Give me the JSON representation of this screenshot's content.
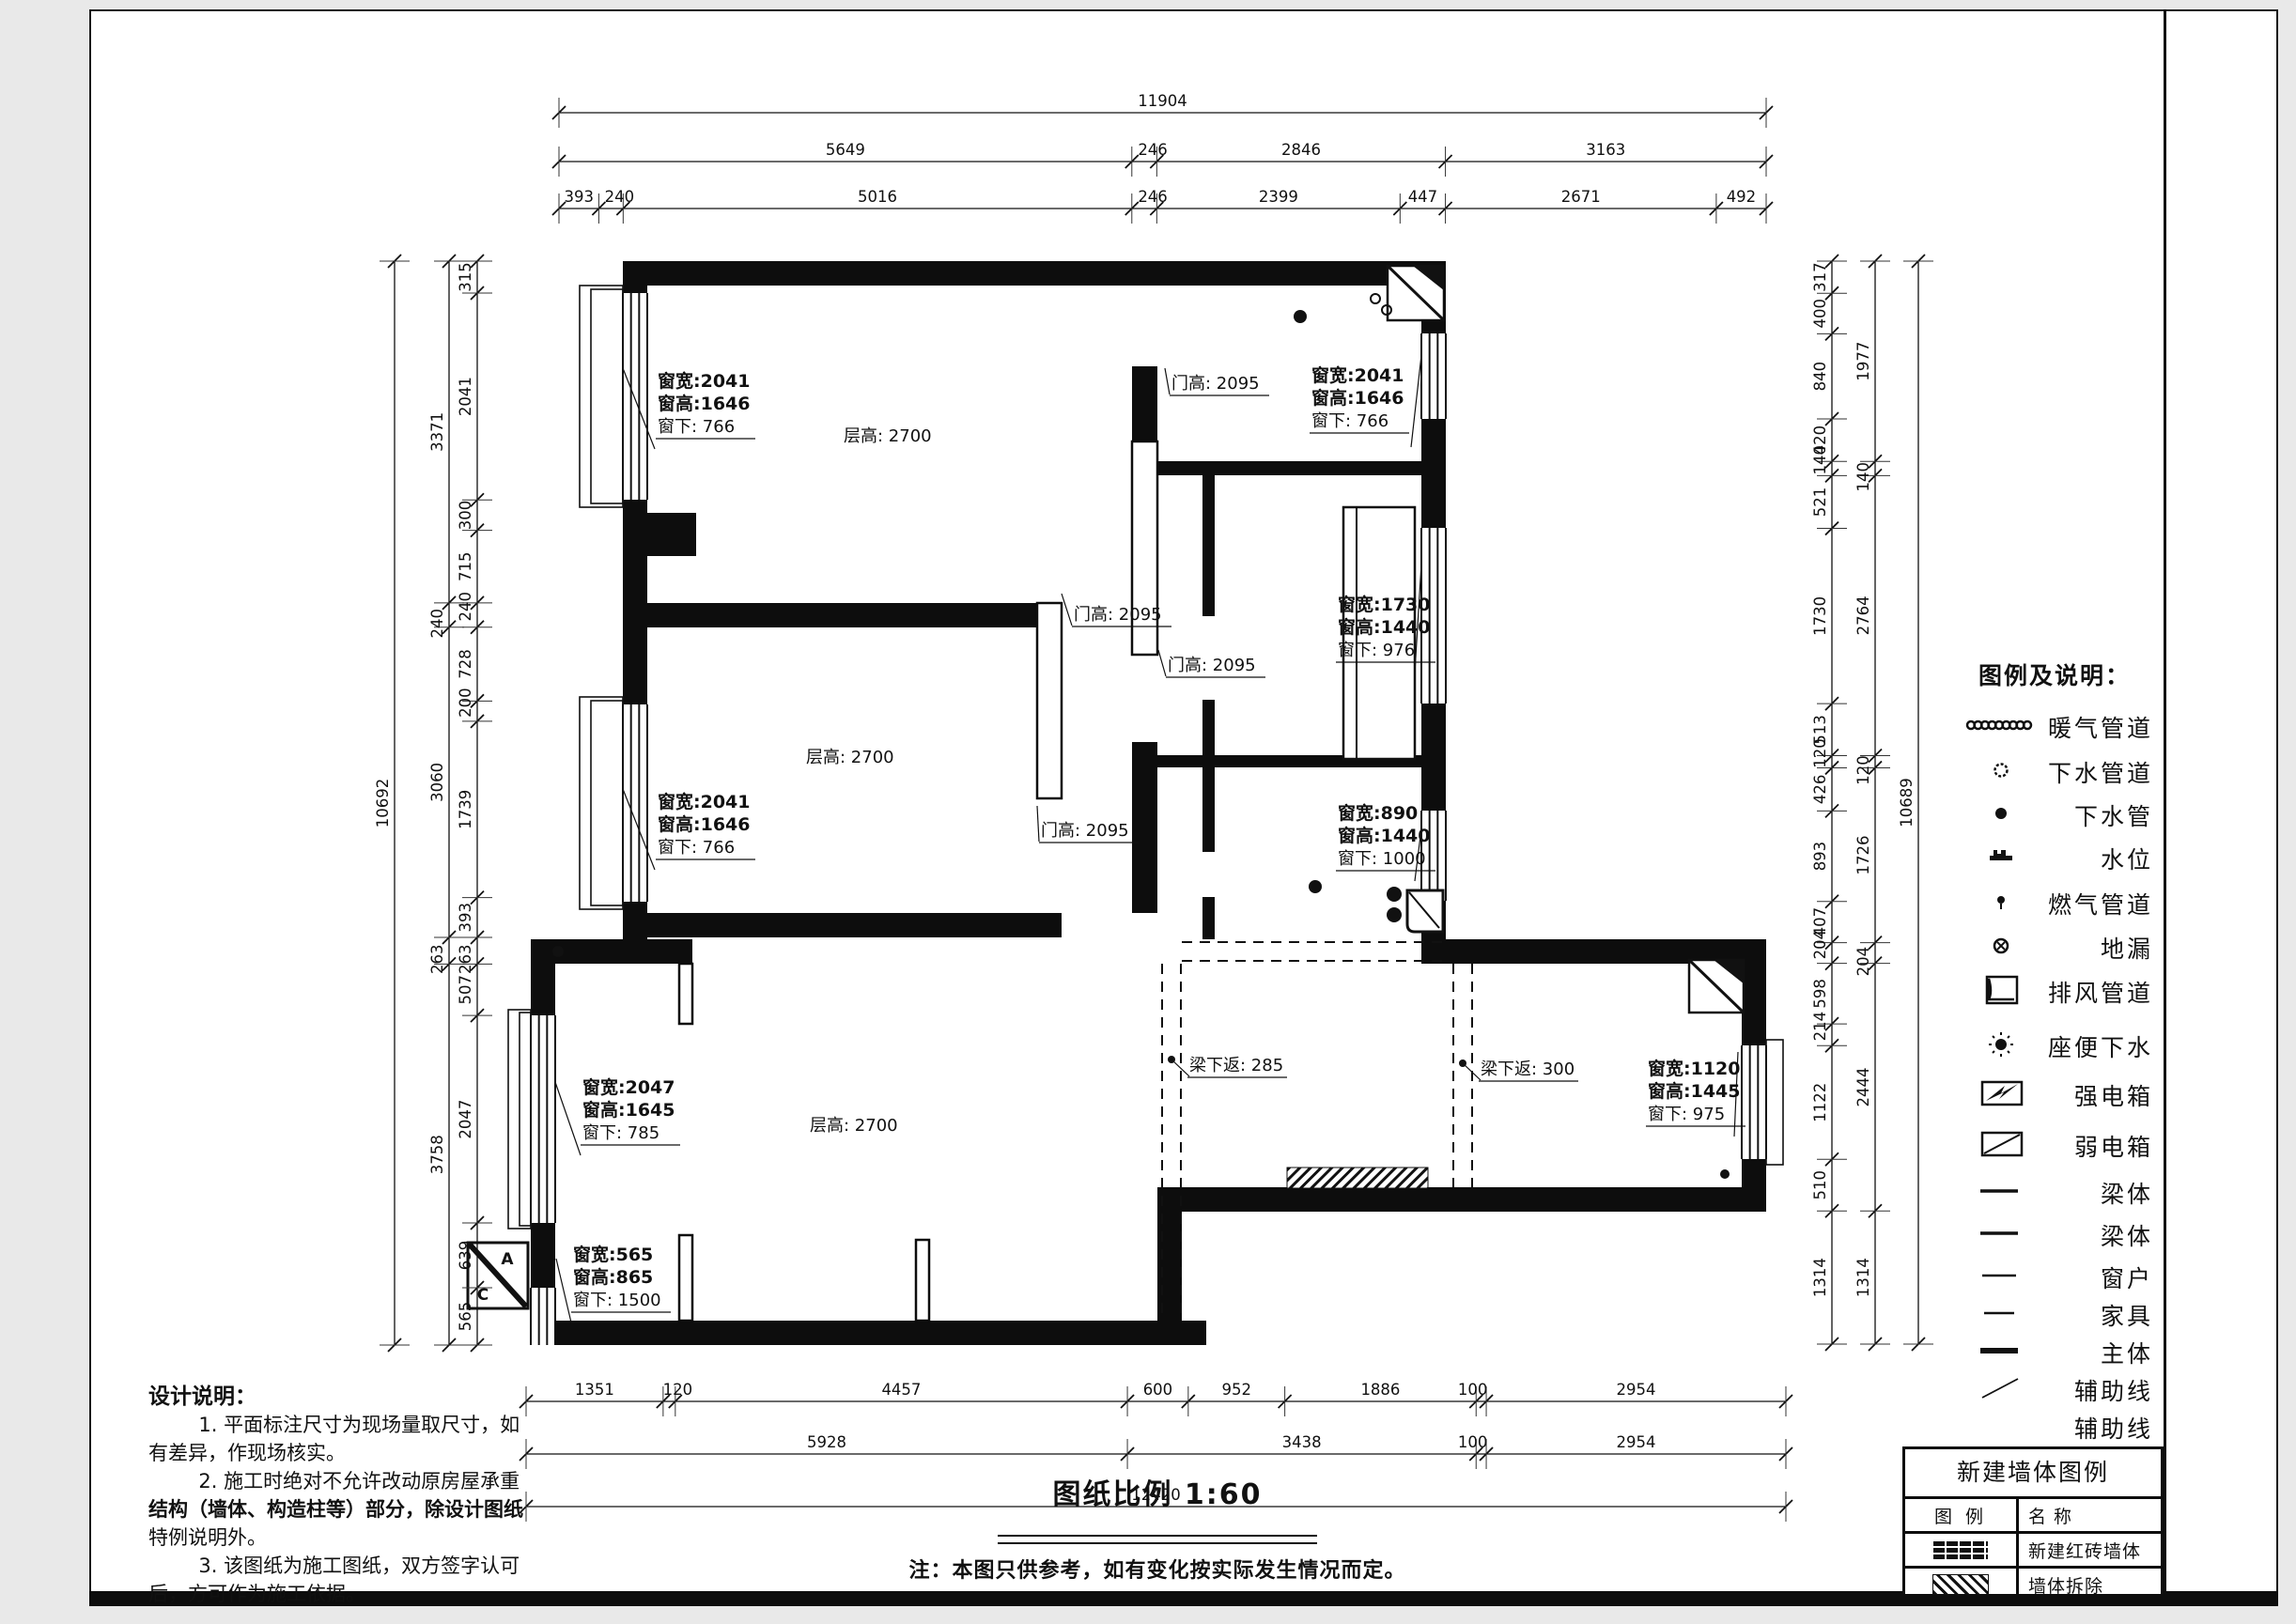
{
  "sheet": {
    "scale_note": "图纸比例 1:60",
    "disclaimer": "注：本图只供参考，如有变化按实际发生情况而定。"
  },
  "dimensions": {
    "top": [
      [
        11904
      ],
      [
        5649,
        246,
        2846,
        3163
      ],
      [
        393,
        240,
        5016,
        246,
        2399,
        447,
        2671,
        492
      ]
    ],
    "left": [
      [
        10692
      ],
      [
        3371,
        240,
        3060,
        263,
        3758
      ],
      [
        315,
        2041,
        300,
        715,
        240,
        728,
        200,
        1739,
        393,
        263,
        507,
        2047,
        639,
        565
      ]
    ],
    "right": [
      [
        317,
        400,
        840,
        420,
        140,
        521,
        1730,
        513,
        120,
        426,
        893,
        407,
        204,
        598,
        214,
        1122,
        510,
        1314
      ],
      [
        1977,
        140,
        2764,
        120,
        1726,
        204,
        2444,
        1314
      ],
      [
        10689
      ]
    ],
    "bottom": [
      [
        1351,
        120,
        4457,
        600,
        952,
        1886,
        100,
        2954
      ],
      [
        5928,
        3438,
        100,
        2954
      ],
      [
        12420
      ]
    ]
  },
  "callouts": [
    {
      "id": "c1",
      "type": "window",
      "lines": [
        "窗宽:2041",
        "窗高:1646",
        "窗下: 766"
      ]
    },
    {
      "id": "c2",
      "type": "height",
      "lines": [
        "层高: 2700"
      ]
    },
    {
      "id": "c3",
      "type": "door",
      "lines": [
        "门高: 2095"
      ]
    },
    {
      "id": "c4",
      "type": "window",
      "lines": [
        "窗宽:2041",
        "窗高:1646",
        "窗下: 766"
      ]
    },
    {
      "id": "c5",
      "type": "window",
      "lines": [
        "窗宽:1730",
        "窗高:1440",
        "窗下: 976"
      ]
    },
    {
      "id": "c6",
      "type": "door",
      "lines": [
        "门高: 2095"
      ]
    },
    {
      "id": "c7",
      "type": "door",
      "lines": [
        "门高: 2095"
      ]
    },
    {
      "id": "c8",
      "type": "height",
      "lines": [
        "层高: 2700"
      ]
    },
    {
      "id": "c9",
      "type": "window",
      "lines": [
        "窗宽:2041",
        "窗高:1646",
        "窗下: 766"
      ]
    },
    {
      "id": "c10",
      "type": "door",
      "lines": [
        "门高: 2095"
      ]
    },
    {
      "id": "c11",
      "type": "window",
      "lines": [
        "窗宽:890",
        "窗高:1440",
        "窗下: 1000"
      ]
    },
    {
      "id": "c12",
      "type": "window",
      "lines": [
        "窗宽:2047",
        "窗高:1645",
        "窗下: 785"
      ]
    },
    {
      "id": "c13",
      "type": "height",
      "lines": [
        "层高: 2700"
      ]
    },
    {
      "id": "c14",
      "type": "beam",
      "lines": [
        "梁下返: 285"
      ]
    },
    {
      "id": "c15",
      "type": "beam",
      "lines": [
        "梁下返: 300"
      ]
    },
    {
      "id": "c16",
      "type": "window",
      "lines": [
        "窗宽:1120",
        "窗高:1445",
        "窗下: 975"
      ]
    },
    {
      "id": "c17",
      "type": "window",
      "lines": [
        "窗宽:565",
        "窗高:865",
        "窗下: 1500"
      ]
    }
  ],
  "legend": {
    "title": "图例及说明：",
    "items": [
      {
        "symbol": "radiator",
        "label": "暖气管道"
      },
      {
        "symbol": "drain-open",
        "label": "下水管道"
      },
      {
        "symbol": "drain-dot",
        "label": "下水管"
      },
      {
        "symbol": "water-level",
        "label": "水位"
      },
      {
        "symbol": "gas",
        "label": "燃气管道"
      },
      {
        "symbol": "floor-drain",
        "label": "地漏"
      },
      {
        "symbol": "vent",
        "label": "排风管道"
      },
      {
        "symbol": "toilet-drain",
        "label": "座便下水"
      },
      {
        "symbol": "strong-box",
        "label": "强电箱"
      },
      {
        "symbol": "weak-box",
        "label": "弱电箱"
      },
      {
        "symbol": "beam-line",
        "label": "梁体"
      },
      {
        "symbol": "beam-line",
        "label": "梁体"
      },
      {
        "symbol": "window-line",
        "label": "窗户"
      },
      {
        "symbol": "furniture-line",
        "label": "家具"
      },
      {
        "symbol": "main-line",
        "label": "主体"
      },
      {
        "symbol": "aux-line",
        "label": "辅助线"
      },
      {
        "symbol": "none",
        "label": "辅助线"
      }
    ]
  },
  "wall_legend": {
    "title": "新建墙体图例",
    "col_symbol": "图 例",
    "col_name": "名 称",
    "rows": [
      {
        "symbol": "brick",
        "label": "新建红砖墙体"
      },
      {
        "symbol": "hatch",
        "label": "墙体拆除"
      }
    ]
  },
  "notes": {
    "lines": [
      {
        "text": "设计说明：",
        "style": "title"
      },
      {
        "text": "        1. 平面标注尺寸为现场量取尺寸，如",
        "style": "normal"
      },
      {
        "text": "有差异，作现场核实。",
        "style": "normal"
      },
      {
        "text": "        2. 施工时绝对不允许改动原房屋承重",
        "style": "normal"
      },
      {
        "text": "结构（墙体、构造柱等）部分，除设计图纸",
        "style": "bold"
      },
      {
        "text": "特例说明外。",
        "style": "normal"
      },
      {
        "text": "        3. 该图纸为施工图纸，双方签字认可",
        "style": "normal"
      },
      {
        "text": "后，方可作为施工依据。",
        "style": "normal"
      }
    ]
  },
  "markers": {
    "elevation_top": "A",
    "elevation_bottom": "C"
  }
}
